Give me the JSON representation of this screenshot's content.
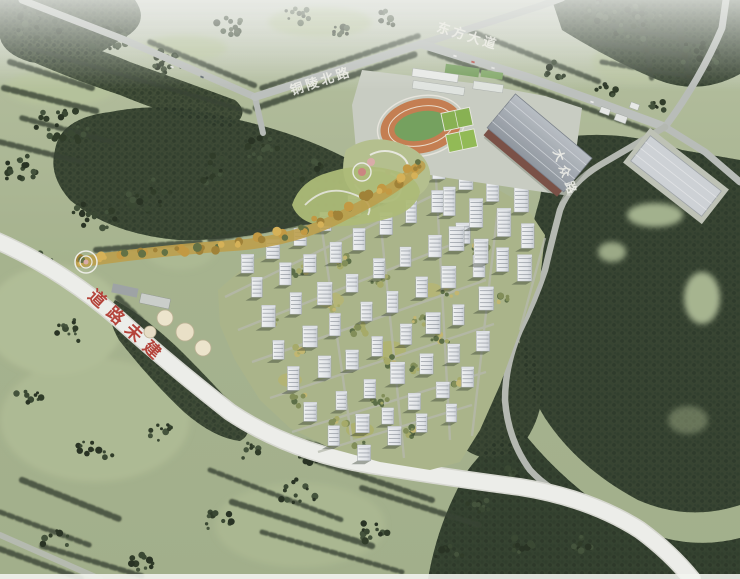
{
  "scene": {
    "description": "Aerial bird's-eye architectural rendering of a planned residential development with central greenway, school sports campus and surrounding forest farmland",
    "palette": {
      "field_green": "#a3b08a",
      "forest_green": "#35422d",
      "road_gray": "#b8bcb8",
      "unbuilt_road_white": "#ecede9",
      "track_orange": "#c2794a",
      "court_green": "#86b04c",
      "gym_roof_gray": "#9aa1a9",
      "greenway_gold": "#c79a3b",
      "label_red": "#b23b32",
      "label_white": "#f0f0ea"
    }
  },
  "road_labels": {
    "north_road": "铜陵北路",
    "east_avenue": "东方大道",
    "side_road": "大众路",
    "unbuilt_road": "道路未建"
  }
}
